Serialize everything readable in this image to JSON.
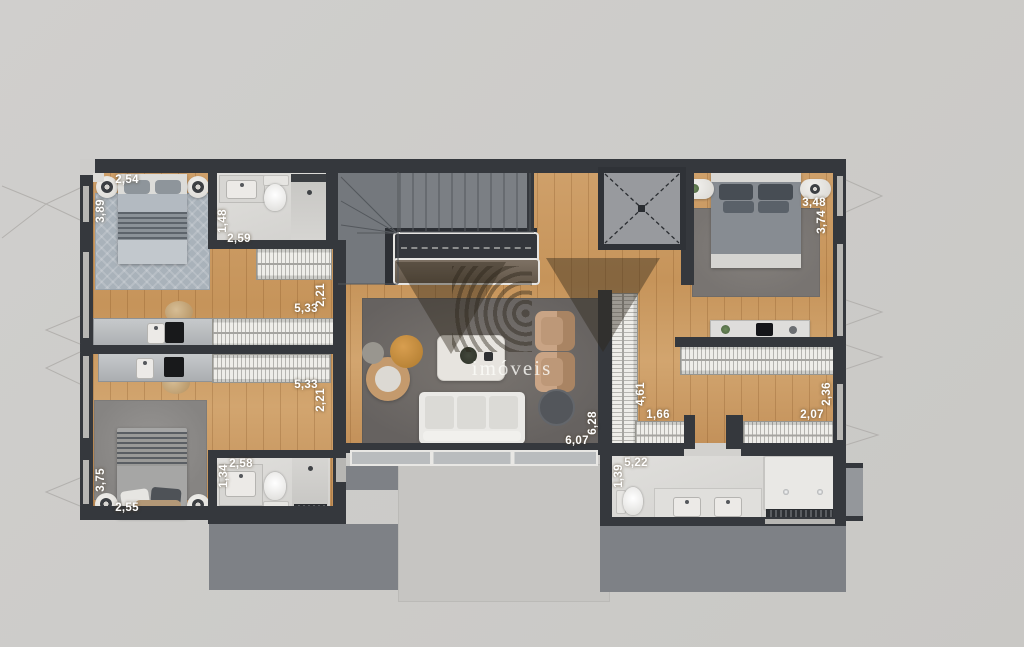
{
  "watermark": {
    "logo": "BV",
    "label": "imóveis"
  },
  "measurements": {
    "bedroom_tl": {
      "w": "2,54",
      "d": "3,89"
    },
    "bath_tl": {
      "w": "2,59",
      "d": "1,48"
    },
    "unit_tl": {
      "w": "5,33",
      "d": "2,21"
    },
    "unit_bl": {
      "w": "5,33",
      "d": "2,21"
    },
    "bedroom_tr": {
      "w": "3,48",
      "d": "3,74"
    },
    "closet_left": {
      "w": "1,66",
      "d": "4,61"
    },
    "closet_right": {
      "w": "2,07",
      "d": "2,36"
    },
    "living": {
      "w": "6,07",
      "d": "6,28"
    },
    "bath_bl": {
      "w": "2,58",
      "d": "1,34"
    },
    "bedroom_bl": {
      "w": "2,55",
      "d": "3,75"
    },
    "bath_master": {
      "w": "5,22",
      "d": "1,39"
    }
  },
  "palette": {
    "background": "#cdccca",
    "wall": "#35383d",
    "wood_floor": "#c9975e",
    "bath_floor": "#dbdad7",
    "stairs": "#7b7f84",
    "terrace_dark": "#7e8186",
    "terrace_light": "#c6c5c2",
    "rug_living": "#6e6964",
    "rug_blue": "#a9b2ba",
    "accent_tan": "#c49a6d",
    "accent_orange": "#c8863c",
    "label_text": "#ffffff"
  }
}
